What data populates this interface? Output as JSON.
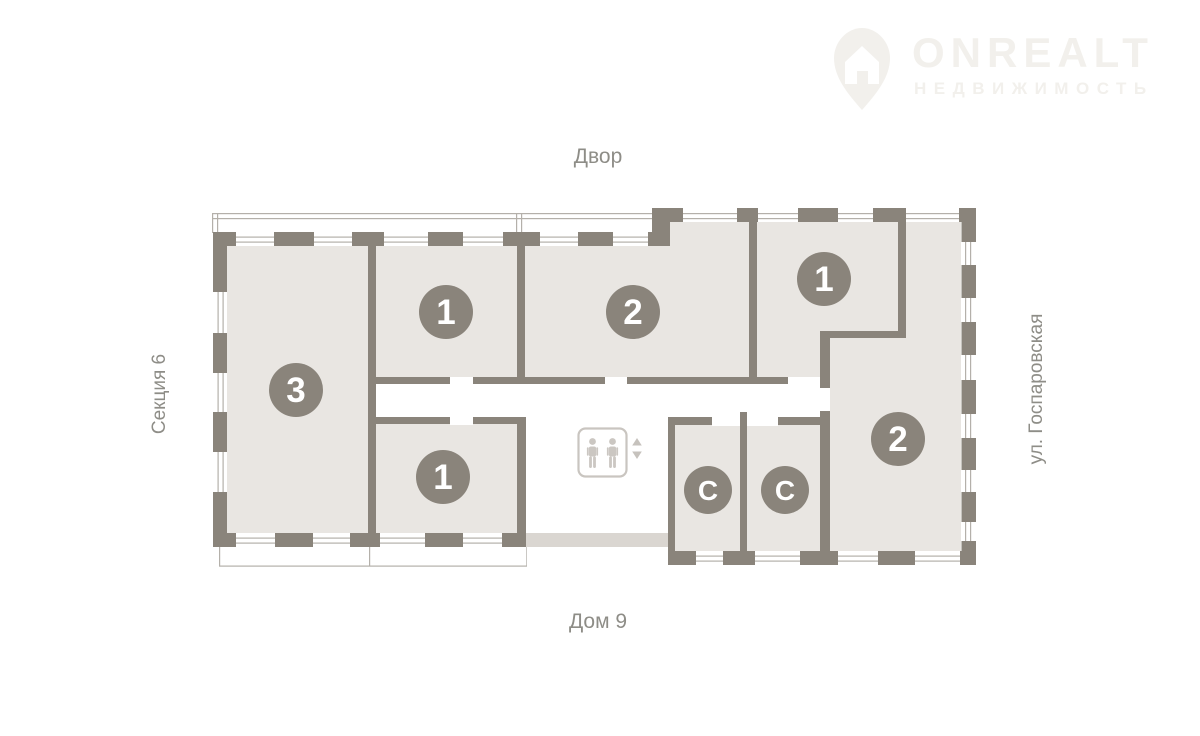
{
  "watermark": {
    "brand": "ONREALT",
    "tagline": "НЕДВИЖИМОСТЬ"
  },
  "labels": {
    "top": "Двор",
    "bottom": "Дом 9",
    "left": "Секция 6",
    "right": "ул. Госпаровская"
  },
  "plan": {
    "rooms": [
      {
        "id": "apartment-3",
        "label": "3"
      },
      {
        "id": "apartment-1-top",
        "label": "1"
      },
      {
        "id": "apartment-2-top",
        "label": "2"
      },
      {
        "id": "apartment-1-right",
        "label": "1"
      },
      {
        "id": "apartment-1-bottom",
        "label": "1"
      },
      {
        "id": "storage-1",
        "label": "С"
      },
      {
        "id": "storage-2",
        "label": "С"
      },
      {
        "id": "apartment-2-right",
        "label": "2"
      }
    ],
    "elevator": {
      "icon": "elevator-two-persons",
      "arrows": [
        "up",
        "down"
      ]
    }
  },
  "colors": {
    "wall": "#8a847b",
    "room_fill": "#e9e6e2",
    "light_wall": "#dad6d1",
    "thin_line": "#b4b0aa",
    "label_text": "#8e8d87",
    "watermark": "#f2f0ec",
    "badge_text": "#ffffff"
  }
}
